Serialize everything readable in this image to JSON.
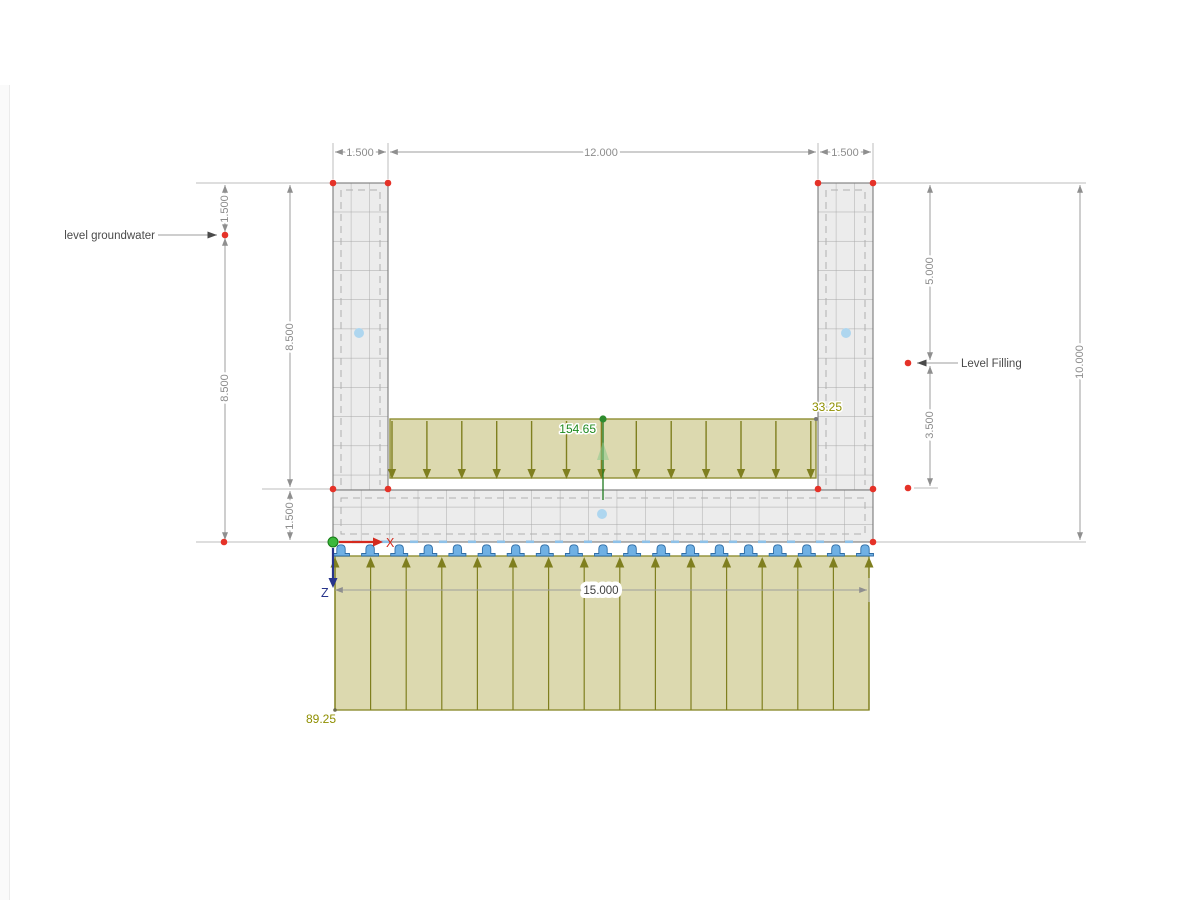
{
  "dimensions": {
    "top_left": "1.500",
    "top_center": "12.000",
    "top_right": "1.500",
    "left_outer_upper": "1.500",
    "left_outer_lower": "8.500",
    "left_inner_upper": "8.500",
    "left_inner_lower": "1.500",
    "right_inner_upper": "5.000",
    "right_inner_lower": "3.500",
    "right_outer": "10.000",
    "bottom": "15.000"
  },
  "labels": {
    "groundwater": "level groundwater",
    "filling": "Level Filling"
  },
  "loads": {
    "filling_top": "154.65",
    "filling_edge": "33.25",
    "soil": "89.25"
  },
  "axes": {
    "x": "X",
    "z": "Z"
  },
  "colors": {
    "load_fill": "#d9d6a8",
    "load_stroke": "#8f8f33",
    "load_arrow": "#7f7f1f",
    "load_value_olive": "#8f8f00",
    "load_value_green": "#1f8a1f",
    "structure_fill": "#ececec",
    "mesh_line": "#a6a6a6",
    "dimension_line": "#9e9e9e",
    "node_red": "#e53228",
    "support_blue": "#6fb0e4",
    "axis_x_red": "#d42a1e",
    "axis_z_blue": "#27348b",
    "surface_dot_blue": "#aed6ef"
  }
}
